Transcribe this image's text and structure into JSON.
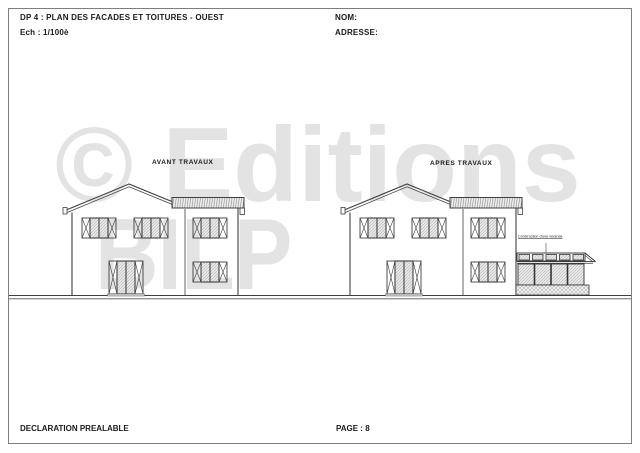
{
  "header": {
    "title": "DP 4 : PLAN DES FACADES ET TOITURES - OUEST",
    "scale": "Ech : 1/100è",
    "name_label": "NOM:",
    "address_label": "ADRESSE:"
  },
  "drawing": {
    "before_label": "AVANT TRAVAUX",
    "after_label": "APRES TRAVAUX",
    "veranda_label": "Construction d'une veranda"
  },
  "watermark": {
    "line1": "© Editions",
    "line2": "BILP"
  },
  "footer": {
    "doc_type": "DECLARATION PREALABLE",
    "page": "PAGE : 8"
  },
  "colors": {
    "line": "#3f3f3f",
    "watermark": "#e3e3e3",
    "border": "#7e7e7e"
  }
}
